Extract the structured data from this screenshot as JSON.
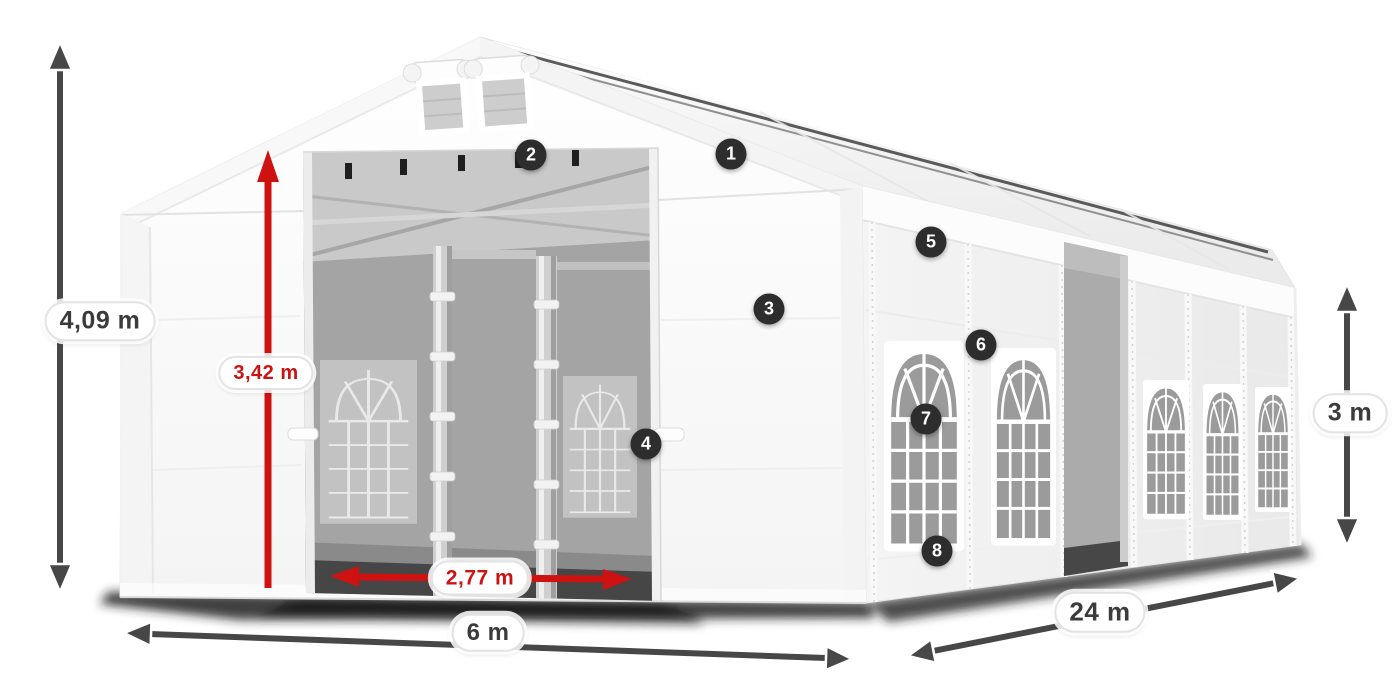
{
  "diagram": {
    "subject": "White marquee tent with dimension annotations",
    "dimensions": {
      "total_height": {
        "label": "4,09 m",
        "color": "#474747",
        "orientation": "vertical"
      },
      "entrance_height": {
        "label": "3,42 m",
        "color": "#ce1212",
        "orientation": "vertical"
      },
      "entrance_width": {
        "label": "2,77 m",
        "color": "#ce1212",
        "orientation": "horizontal"
      },
      "front_width": {
        "label": "6 m",
        "color": "#474747",
        "orientation": "horizontal"
      },
      "side_length": {
        "label": "24 m",
        "color": "#474747",
        "orientation": "diagonal"
      },
      "side_height": {
        "label": "3 m",
        "color": "#474747",
        "orientation": "vertical"
      }
    },
    "callouts": [
      {
        "number": "1"
      },
      {
        "number": "2"
      },
      {
        "number": "3"
      },
      {
        "number": "4"
      },
      {
        "number": "5"
      },
      {
        "number": "6"
      },
      {
        "number": "7"
      },
      {
        "number": "8"
      }
    ],
    "colors": {
      "dimension_red": "#ce1212",
      "dimension_gray": "#474747",
      "callout_bg": "#2d2d2d",
      "callout_text": "#ffffff",
      "tent_fabric": "#ffffff",
      "interior_gray": "#a4a4a4",
      "window_glass": "#9b9b9b"
    }
  }
}
